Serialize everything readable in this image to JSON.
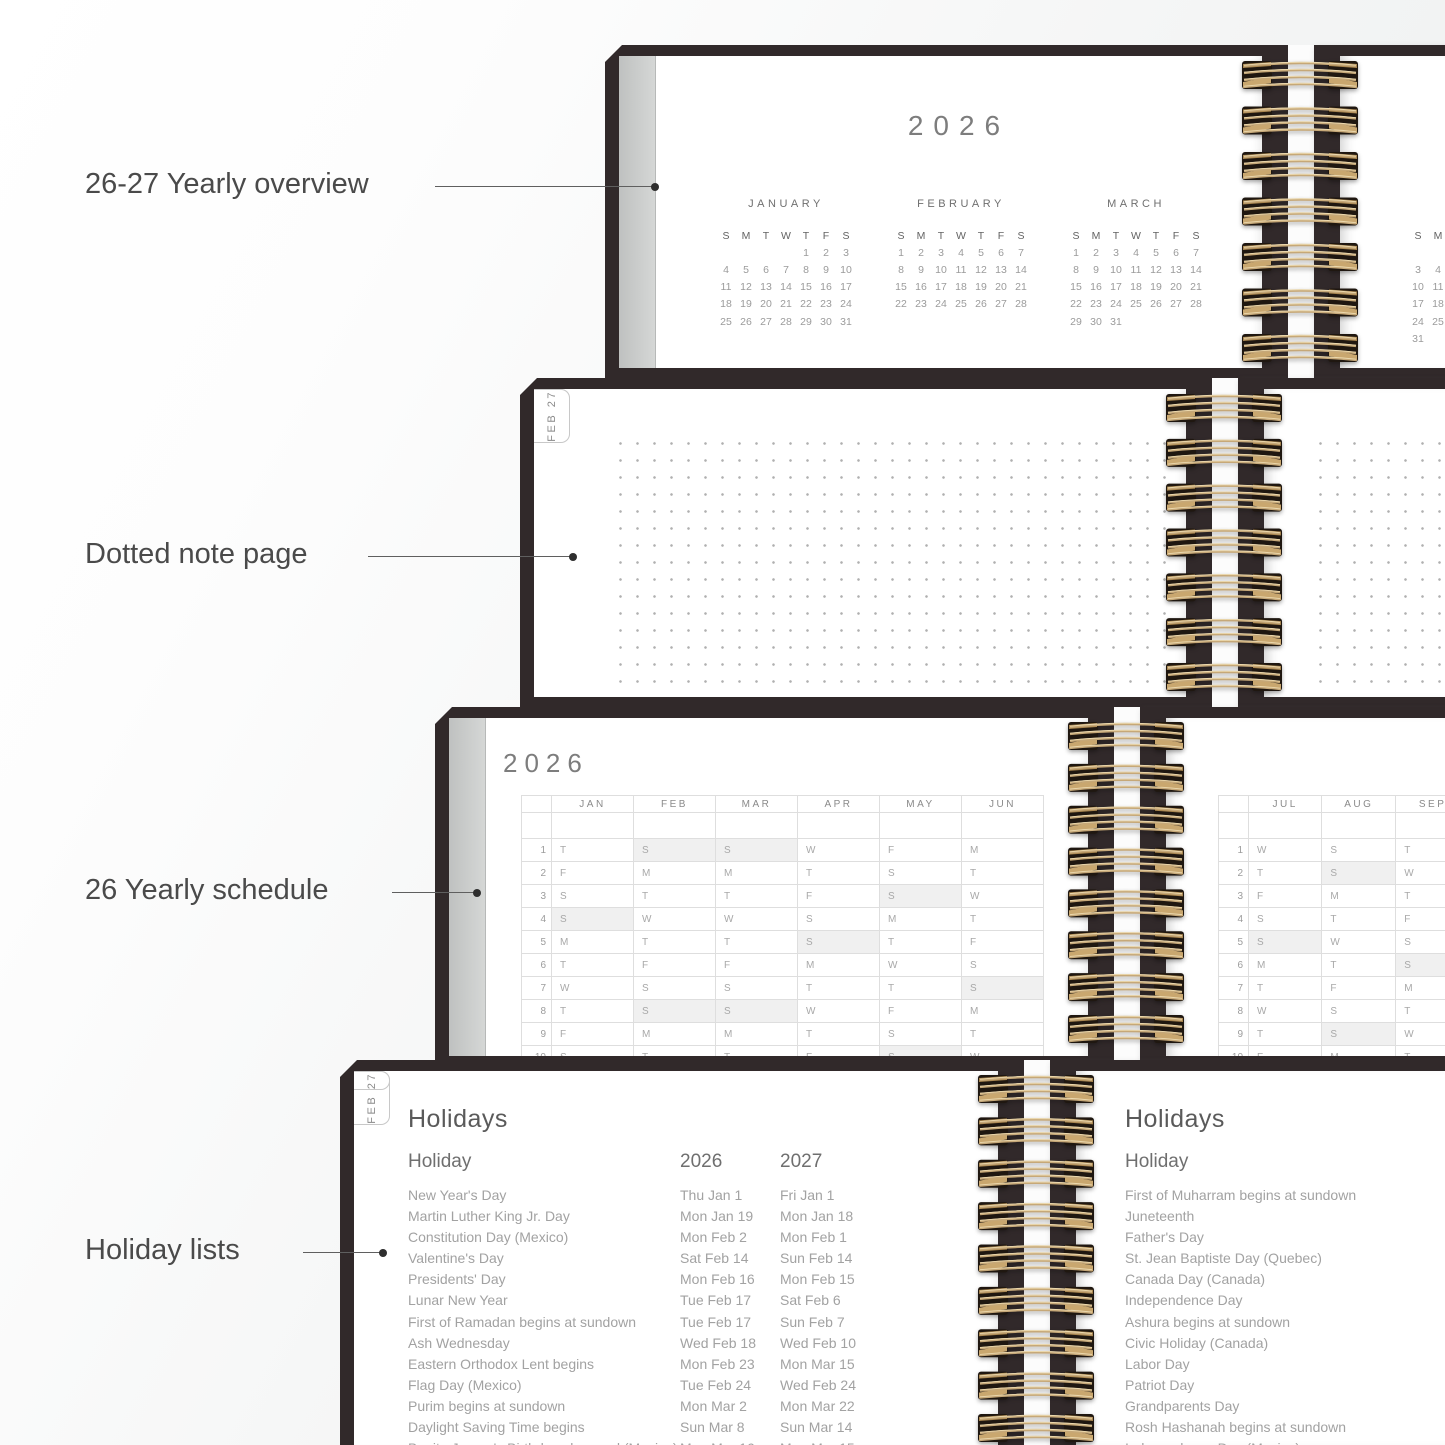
{
  "colors": {
    "cover_frame": "#31292a",
    "coil_gold": "#c6a878",
    "coil_dark": "#1f1710",
    "page_edge_gray": "#c9cbca",
    "shaded_cell": "#f0f0f0",
    "annotation_text": "#4a4a4a"
  },
  "annotations": {
    "items": [
      {
        "label": "26-27 Yearly overview"
      },
      {
        "label": "Dotted note page"
      },
      {
        "label": "26 Yearly schedule"
      },
      {
        "label": "Holiday lists"
      }
    ]
  },
  "yearly_overview": {
    "year": "2026",
    "day_headers": [
      "S",
      "M",
      "T",
      "W",
      "T",
      "F",
      "S"
    ],
    "months": [
      {
        "name": "JANUARY",
        "weeks": [
          [
            "",
            "",
            "",
            "",
            "1",
            "2",
            "3"
          ],
          [
            "4",
            "5",
            "6",
            "7",
            "8",
            "9",
            "10"
          ],
          [
            "11",
            "12",
            "13",
            "14",
            "15",
            "16",
            "17"
          ],
          [
            "18",
            "19",
            "20",
            "21",
            "22",
            "23",
            "24"
          ],
          [
            "25",
            "26",
            "27",
            "28",
            "29",
            "30",
            "31"
          ]
        ]
      },
      {
        "name": "FEBRUARY",
        "weeks": [
          [
            "1",
            "2",
            "3",
            "4",
            "5",
            "6",
            "7"
          ],
          [
            "8",
            "9",
            "10",
            "11",
            "12",
            "13",
            "14"
          ],
          [
            "15",
            "16",
            "17",
            "18",
            "19",
            "20",
            "21"
          ],
          [
            "22",
            "23",
            "24",
            "25",
            "26",
            "27",
            "28"
          ]
        ]
      },
      {
        "name": "MARCH",
        "weeks": [
          [
            "1",
            "2",
            "3",
            "4",
            "5",
            "6",
            "7"
          ],
          [
            "8",
            "9",
            "10",
            "11",
            "12",
            "13",
            "14"
          ],
          [
            "15",
            "16",
            "17",
            "18",
            "19",
            "20",
            "21"
          ],
          [
            "22",
            "23",
            "24",
            "25",
            "26",
            "27",
            "28"
          ],
          [
            "29",
            "30",
            "31",
            "",
            "",
            "",
            ""
          ]
        ]
      }
    ],
    "right_page_fragment": {
      "day_headers": [
        "S",
        "M"
      ],
      "rows": [
        [
          "",
          ""
        ],
        [
          "3",
          "4"
        ],
        [
          "10",
          "11"
        ],
        [
          "17",
          "18"
        ],
        [
          "24",
          "25"
        ],
        [
          "31",
          ""
        ]
      ]
    }
  },
  "note_page": {
    "tabs": [
      "JAN 27",
      "FEB 27"
    ]
  },
  "yearly_schedule": {
    "year": "2026",
    "left_months": [
      "JAN",
      "FEB",
      "MAR",
      "APR",
      "MAY",
      "JUN"
    ],
    "left_rows": [
      {
        "n": "1",
        "cells": [
          "T",
          "S*",
          "S*",
          "W",
          "F",
          "M"
        ]
      },
      {
        "n": "2",
        "cells": [
          "F",
          "M",
          "M",
          "T",
          "S",
          "T"
        ]
      },
      {
        "n": "3",
        "cells": [
          "S",
          "T",
          "T",
          "F",
          "S*",
          "W"
        ]
      },
      {
        "n": "4",
        "cells": [
          "S*",
          "W",
          "W",
          "S",
          "M",
          "T"
        ]
      },
      {
        "n": "5",
        "cells": [
          "M",
          "T",
          "T",
          "S*",
          "T",
          "F"
        ]
      },
      {
        "n": "6",
        "cells": [
          "T",
          "F",
          "F",
          "M",
          "W",
          "S"
        ]
      },
      {
        "n": "7",
        "cells": [
          "W",
          "S",
          "S",
          "T",
          "T",
          "S*"
        ]
      },
      {
        "n": "8",
        "cells": [
          "T",
          "S*",
          "S*",
          "W",
          "F",
          "M"
        ]
      },
      {
        "n": "9",
        "cells": [
          "F",
          "M",
          "M",
          "T",
          "S",
          "T"
        ]
      },
      {
        "n": "10",
        "cells": [
          "S",
          "T",
          "T",
          "F",
          "S*",
          "W"
        ]
      }
    ],
    "right_months": [
      "JUL",
      "AUG",
      "SEP"
    ],
    "right_rows": [
      {
        "n": "1",
        "cells": [
          "W",
          "S",
          "T"
        ]
      },
      {
        "n": "2",
        "cells": [
          "T",
          "S*",
          "W"
        ]
      },
      {
        "n": "3",
        "cells": [
          "F",
          "M",
          "T"
        ]
      },
      {
        "n": "4",
        "cells": [
          "S",
          "T",
          "F"
        ]
      },
      {
        "n": "5",
        "cells": [
          "S*",
          "W",
          "S"
        ]
      },
      {
        "n": "6",
        "cells": [
          "M",
          "T",
          "S*"
        ]
      },
      {
        "n": "7",
        "cells": [
          "T",
          "F",
          "M"
        ]
      },
      {
        "n": "8",
        "cells": [
          "W",
          "S",
          "T"
        ]
      },
      {
        "n": "9",
        "cells": [
          "T",
          "S*",
          "W"
        ]
      },
      {
        "n": "10",
        "cells": [
          "F",
          "M",
          "T"
        ]
      }
    ]
  },
  "holidays": {
    "title": "Holidays",
    "col_holiday": "Holiday",
    "col_2026": "2026",
    "col_2027": "2027",
    "tabs": [
      "JAN 27",
      "FEB 27",
      "27"
    ],
    "rows": [
      [
        "New Year's Day",
        "Thu Jan 1",
        "Fri Jan 1"
      ],
      [
        "Martin Luther King Jr. Day",
        "Mon Jan 19",
        "Mon Jan 18"
      ],
      [
        "Constitution Day (Mexico)",
        "Mon Feb 2",
        "Mon Feb 1"
      ],
      [
        "Valentine's Day",
        "Sat Feb 14",
        "Sun Feb 14"
      ],
      [
        "Presidents' Day",
        "Mon Feb 16",
        "Mon Feb 15"
      ],
      [
        "Lunar New Year",
        "Tue Feb 17",
        "Sat Feb 6"
      ],
      [
        "First of Ramadan begins at sundown",
        "Tue Feb 17",
        "Sun Feb 7"
      ],
      [
        "Ash Wednesday",
        "Wed Feb 18",
        "Wed Feb 10"
      ],
      [
        "Eastern Orthodox Lent begins",
        "Mon Feb 23",
        "Mon Mar 15"
      ],
      [
        "Flag Day (Mexico)",
        "Tue Feb 24",
        "Wed Feb 24"
      ],
      [
        "Purim begins at sundown",
        "Mon Mar 2",
        "Mon Mar 22"
      ],
      [
        "Daylight Saving Time begins",
        "Sun Mar 8",
        "Sun Mar 14"
      ],
      [
        "Benito Juarez's Birthday observed (Mexico)",
        "Mon Mar 16",
        "Mon Mar 15"
      ]
    ],
    "right_title": "Holidays",
    "right_col_holiday": "Holiday",
    "right_rows": [
      "First of Muharram begins at sundown",
      "Juneteenth",
      "Father's Day",
      "St. Jean Baptiste Day (Quebec)",
      "Canada Day (Canada)",
      "Independence Day",
      "Ashura begins at sundown",
      "Civic Holiday (Canada)",
      "Labor Day",
      "Patriot Day",
      "Grandparents Day",
      "Rosh Hashanah begins at sundown",
      "Independence Day (Mexico)"
    ]
  }
}
